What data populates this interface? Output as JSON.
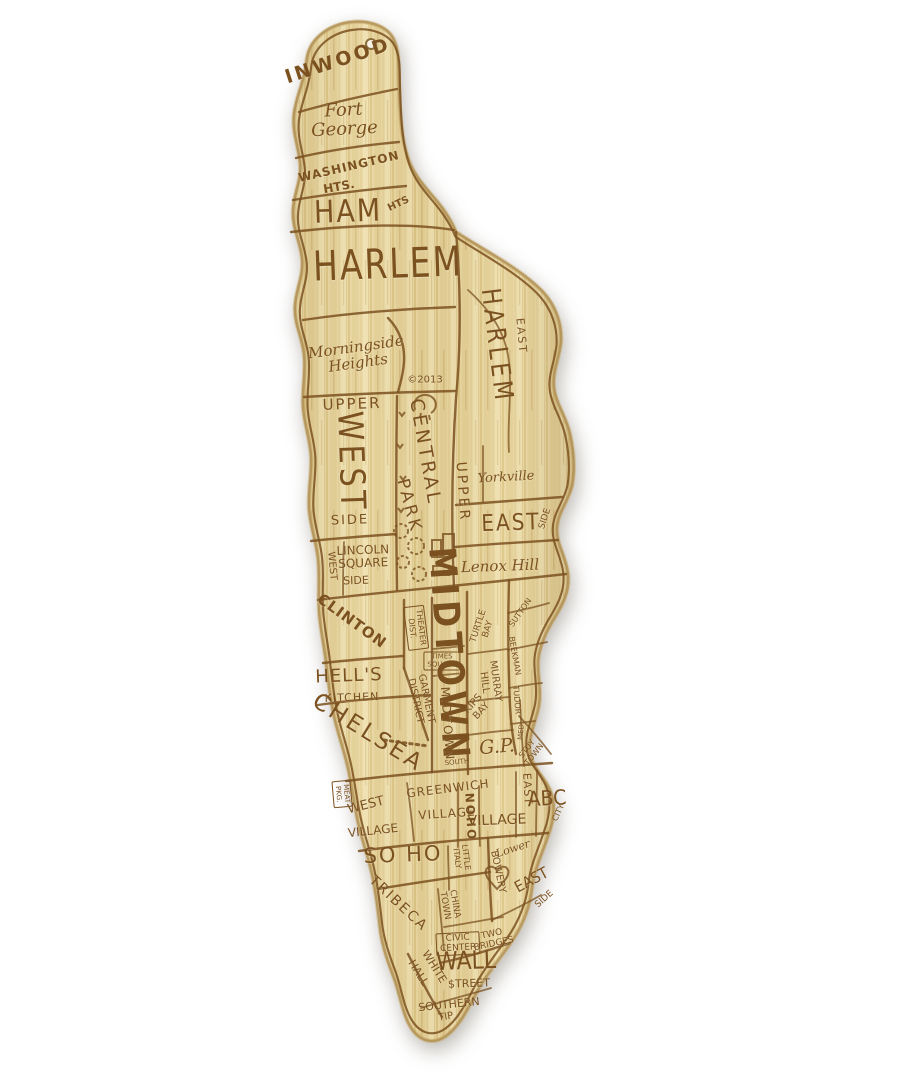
{
  "image_kind": "engraved bamboo cutting board shaped like Manhattan with hand-drawn neighborhood map",
  "colors": {
    "background": "#ffffff",
    "board_base": "#e8d6a0",
    "board_light": "#eedfae",
    "board_dark": "#d9c184",
    "board_edge": "#a98c54",
    "engrave": "#7b5120"
  },
  "decorations": [
    "hang-hole",
    "reservoir-doodle",
    "tree-doodles",
    "skyline-doodle",
    "heart-doodle",
    "dotted-street"
  ],
  "board": {
    "copyright": "©2013",
    "labels": [
      {
        "id": "inwood",
        "text": "INWOOD",
        "x": 338,
        "y": 61,
        "rot": -18,
        "fs": 19,
        "ls": 3,
        "w": 600
      },
      {
        "id": "fort-george",
        "text": "Fort\nGeorge",
        "x": 344,
        "y": 120,
        "rot": -3,
        "fs": 18,
        "it": true
      },
      {
        "id": "washington",
        "text": "WASHINGTON",
        "x": 349,
        "y": 167,
        "rot": -13,
        "fs": 12,
        "w": 700,
        "ls": 1
      },
      {
        "id": "washington-hts",
        "text": "HTS.",
        "x": 339,
        "y": 187,
        "rot": -10,
        "fs": 12,
        "w": 700
      },
      {
        "id": "hamilton",
        "text": "HAM",
        "x": 348,
        "y": 212,
        "rot": -2,
        "fs": 27,
        "ls": 2,
        "sy": 1.15
      },
      {
        "id": "hamilton-hts",
        "text": "HTS",
        "x": 399,
        "y": 205,
        "rot": -25,
        "fs": 10,
        "w": 600
      },
      {
        "id": "harlem",
        "text": "HARLEM",
        "x": 388,
        "y": 264,
        "rot": -2,
        "fs": 33,
        "ls": 2,
        "sy": 1.25
      },
      {
        "id": "morningside-heights",
        "text": "Morningside\nHeights",
        "x": 357,
        "y": 355,
        "rot": -8,
        "fs": 15,
        "it": true
      },
      {
        "id": "copyright",
        "text": "©2013",
        "x": 425,
        "y": 381,
        "rot": 0,
        "fs": 10
      },
      {
        "id": "east-harlem-east",
        "text": "EAST",
        "x": 521,
        "y": 336,
        "rot": 85,
        "fs": 11,
        "ls": 2
      },
      {
        "id": "east-harlem",
        "text": "HARLEM",
        "x": 496,
        "y": 346,
        "rot": 83,
        "fs": 22,
        "ls": 4,
        "sy": 1.2
      },
      {
        "id": "upper-west-upper",
        "text": "UPPER",
        "x": 352,
        "y": 404,
        "rot": -2,
        "fs": 15,
        "ls": 2
      },
      {
        "id": "upper-west-west",
        "text": "WEST",
        "x": 350,
        "y": 462,
        "rot": 88,
        "fs": 30,
        "ls": 4,
        "sy": 1.15
      },
      {
        "id": "upper-west-side",
        "text": "SIDE",
        "x": 350,
        "y": 521,
        "rot": -2,
        "fs": 13,
        "ls": 2
      },
      {
        "id": "central-park-central",
        "text": "CENTRAL",
        "x": 425,
        "y": 452,
        "rot": 80,
        "fs": 19,
        "ls": 3
      },
      {
        "id": "central-park-park",
        "text": "PARK",
        "x": 409,
        "y": 506,
        "rot": 75,
        "fs": 17,
        "ls": 3
      },
      {
        "id": "upper-east-upper",
        "text": "UPPER",
        "x": 462,
        "y": 492,
        "rot": 86,
        "fs": 14,
        "ls": 3
      },
      {
        "id": "yorkville",
        "text": "Yorkville",
        "x": 506,
        "y": 478,
        "rot": -3,
        "fs": 13,
        "it": true
      },
      {
        "id": "upper-east-east",
        "text": "EAST",
        "x": 511,
        "y": 523,
        "rot": -2,
        "fs": 20,
        "ls": 2,
        "sy": 1.15
      },
      {
        "id": "upper-east-side",
        "text": "SIDE",
        "x": 546,
        "y": 519,
        "rot": -72,
        "fs": 9
      },
      {
        "id": "lincoln-square",
        "text": "LINCOLN\nSQUARE",
        "x": 363,
        "y": 557,
        "rot": -2,
        "fs": 12
      },
      {
        "id": "west-side-west",
        "text": "WEST",
        "x": 331,
        "y": 566,
        "rot": 85,
        "fs": 10
      },
      {
        "id": "west-side-side",
        "text": "SIDE",
        "x": 356,
        "y": 581,
        "rot": -2,
        "fs": 11
      },
      {
        "id": "lenox-hill",
        "text": "Lenox Hill",
        "x": 500,
        "y": 566,
        "rot": -2,
        "fs": 15,
        "it": true
      },
      {
        "id": "clinton",
        "text": "CLINTON",
        "x": 352,
        "y": 621,
        "rot": 36,
        "fs": 15,
        "w": 700,
        "ls": 1
      },
      {
        "id": "theater-district",
        "text": "THEATER\nDIST.",
        "x": 416,
        "y": 628,
        "rot": 83,
        "fs": 8,
        "boxed": true
      },
      {
        "id": "times-square",
        "text": "TIMES\nSQUARE",
        "x": 442,
        "y": 661,
        "rot": 0,
        "fs": 7,
        "boxed": true
      },
      {
        "id": "midtown",
        "text": "MIDTOWN",
        "x": 449,
        "y": 655,
        "rot": 86,
        "fs": 32,
        "ls": 5,
        "w": 700,
        "sy": 1.15
      },
      {
        "id": "turtle-bay",
        "text": "TURTLE\nBAY",
        "x": 484,
        "y": 628,
        "rot": -72,
        "fs": 9
      },
      {
        "id": "sutton",
        "text": "SUTTON",
        "x": 521,
        "y": 613,
        "rot": -55,
        "fs": 8
      },
      {
        "id": "beekman",
        "text": "BEEKMAN",
        "x": 514,
        "y": 656,
        "rot": 80,
        "fs": 8
      },
      {
        "id": "tudor",
        "text": "TUDOR",
        "x": 516,
        "y": 700,
        "rot": 85,
        "fs": 8
      },
      {
        "id": "med",
        "text": "MED.",
        "x": 522,
        "y": 731,
        "rot": -85,
        "fs": 7
      },
      {
        "id": "hells",
        "text": "HELL'S",
        "x": 349,
        "y": 676,
        "rot": -2,
        "fs": 18,
        "ls": 1
      },
      {
        "id": "hells-kitchen",
        "text": "KITCHEN",
        "x": 352,
        "y": 698,
        "rot": -2,
        "fs": 11,
        "ls": 1
      },
      {
        "id": "garment-district",
        "text": "GARMENT\nDISTRICT",
        "x": 420,
        "y": 700,
        "rot": 78,
        "fs": 10
      },
      {
        "id": "murray-hill",
        "text": "MURRAY\nHILL",
        "x": 489,
        "y": 682,
        "rot": 82,
        "fs": 10
      },
      {
        "id": "chelsea",
        "text": "CHELSEA",
        "x": 368,
        "y": 733,
        "rot": 32,
        "fs": 23,
        "ls": 3
      },
      {
        "id": "midtown-south-midtown",
        "text": "MIDTOWN",
        "x": 447,
        "y": 724,
        "rot": 86,
        "fs": 12,
        "ls": 2
      },
      {
        "id": "midtown-south-south",
        "text": "SOUTH",
        "x": 457,
        "y": 763,
        "rot": -5,
        "fs": 7
      },
      {
        "id": "kips-bay",
        "text": "KIPS\nBAY",
        "x": 478,
        "y": 708,
        "rot": -48,
        "fs": 10
      },
      {
        "id": "gramercy-park",
        "text": "G.P.",
        "x": 497,
        "y": 747,
        "rot": -5,
        "fs": 19,
        "it": true
      },
      {
        "id": "stuy-town",
        "text": "STUY\nTOWN",
        "x": 531,
        "y": 752,
        "rot": -52,
        "fs": 8
      },
      {
        "id": "meatpacking",
        "text": "MEAT\nPKG.",
        "x": 342,
        "y": 794,
        "rot": 85,
        "fs": 7,
        "boxed": true
      },
      {
        "id": "west-village-west",
        "text": "WEST",
        "x": 366,
        "y": 806,
        "rot": -14,
        "fs": 13
      },
      {
        "id": "west-village-village",
        "text": "VILLAGE",
        "x": 373,
        "y": 831,
        "rot": -6,
        "fs": 12
      },
      {
        "id": "greenwich",
        "text": "GREENWICH",
        "x": 448,
        "y": 789,
        "rot": -7,
        "fs": 12,
        "ls": 1
      },
      {
        "id": "greenwich-village",
        "text": "VILLAGE",
        "x": 447,
        "y": 814,
        "rot": -4,
        "fs": 12,
        "ls": 1
      },
      {
        "id": "noho",
        "text": "NOHO",
        "x": 470,
        "y": 817,
        "rot": 87,
        "fs": 12,
        "w": 700,
        "ls": 2
      },
      {
        "id": "east-village-village",
        "text": "VILLAGE",
        "x": 497,
        "y": 821,
        "rot": -2,
        "fs": 14
      },
      {
        "id": "east-village-east",
        "text": "EAST",
        "x": 527,
        "y": 789,
        "rot": 87,
        "fs": 11,
        "ls": 1
      },
      {
        "id": "alphabet-city-abc",
        "text": "ABC",
        "x": 547,
        "y": 799,
        "rot": -3,
        "fs": 19,
        "sy": 1.1
      },
      {
        "id": "alphabet-city-city",
        "text": "CITY",
        "x": 559,
        "y": 813,
        "rot": -65,
        "fs": 8
      },
      {
        "id": "little-italy",
        "text": "LITTLE\nITALY",
        "x": 461,
        "y": 858,
        "rot": 83,
        "fs": 8
      },
      {
        "id": "soho",
        "text": "SO HO",
        "x": 403,
        "y": 855,
        "rot": -2,
        "fs": 21,
        "ls": 2
      },
      {
        "id": "bowery",
        "text": "BOWERY",
        "x": 497,
        "y": 872,
        "rot": 78,
        "fs": 10
      },
      {
        "id": "lower",
        "text": "Lower",
        "x": 513,
        "y": 849,
        "rot": -18,
        "fs": 11,
        "it": true
      },
      {
        "id": "lower-east",
        "text": "EAST",
        "x": 532,
        "y": 881,
        "rot": -28,
        "fs": 14,
        "sy": 1.1
      },
      {
        "id": "lower-east-side",
        "text": "SIDE",
        "x": 545,
        "y": 900,
        "rot": -42,
        "fs": 9
      },
      {
        "id": "tribeca",
        "text": "TRIBECA",
        "x": 398,
        "y": 904,
        "rot": 43,
        "fs": 14,
        "ls": 2
      },
      {
        "id": "chinatown",
        "text": "CHINA\nTOWN",
        "x": 449,
        "y": 905,
        "rot": 80,
        "fs": 9
      },
      {
        "id": "civic-center",
        "text": "CIVIC\nCENTER",
        "x": 458,
        "y": 944,
        "rot": -3,
        "fs": 9,
        "boxed": true
      },
      {
        "id": "two-bridges",
        "text": "TWO\nBRIDGES",
        "x": 493,
        "y": 940,
        "rot": -12,
        "fs": 9
      },
      {
        "id": "wall",
        "text": "WALL",
        "x": 466,
        "y": 962,
        "rot": -2,
        "fs": 22,
        "sy": 1.15
      },
      {
        "id": "wall-street",
        "text": "$TREET",
        "x": 469,
        "y": 984,
        "rot": -2,
        "fs": 11
      },
      {
        "id": "white-hall-white",
        "text": "WHITE",
        "x": 434,
        "y": 967,
        "rot": 58,
        "fs": 11
      },
      {
        "id": "white-hall-hall",
        "text": "HALL",
        "x": 418,
        "y": 973,
        "rot": 58,
        "fs": 11
      },
      {
        "id": "southern-tip",
        "text": "SOUTHERN",
        "x": 449,
        "y": 1005,
        "rot": -6,
        "fs": 11
      },
      {
        "id": "southern-tip-tip",
        "text": "TIP",
        "x": 446,
        "y": 1018,
        "rot": -10,
        "fs": 10
      }
    ]
  }
}
